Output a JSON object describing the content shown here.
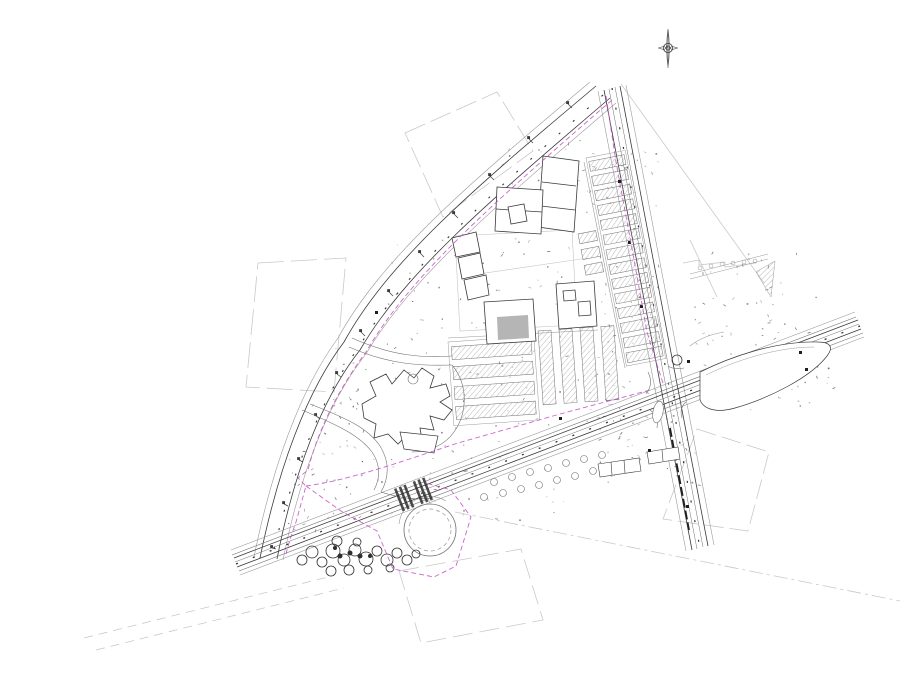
{
  "document": {
    "kind": "cad-site-plan-drawing",
    "background": "#ffffff"
  },
  "palette": {
    "paper": "#ffffff",
    "ink": "#3a3a3a",
    "mid": "#6f6f6f",
    "light": "#9a9a9a",
    "faint": "#c9c9c9",
    "dark": "#1f1f1f",
    "boundary": "#c655c6",
    "building_fill": "#b5b5b5",
    "tree_dark": "#2e2e2e"
  },
  "features": [
    {
      "name": "north-arrow",
      "glyph": "compass-needle"
    },
    {
      "name": "west-curved-road",
      "glyph": "multi-line road band"
    },
    {
      "name": "east-road",
      "glyph": "multi-line road band"
    },
    {
      "name": "south-road",
      "glyph": "multi-line road band"
    },
    {
      "name": "road-intersection",
      "glyph": "crossing with corner fillets"
    },
    {
      "name": "traffic-island",
      "glyph": "teardrop island"
    },
    {
      "name": "main-building-complex",
      "glyph": "courtyard building outlines"
    },
    {
      "name": "west-building",
      "glyph": "irregular star footprint"
    },
    {
      "name": "central-parking-lot",
      "glyph": "hatched stall rows"
    },
    {
      "name": "east-parking-column",
      "glyph": "stacked hatched stall rows"
    },
    {
      "name": "site-boundary",
      "glyph": "magenta dashed line"
    },
    {
      "name": "pond",
      "glyph": "concentric circles"
    },
    {
      "name": "tree-cluster",
      "glyph": "overlapping canopy circles"
    },
    {
      "name": "street-trees",
      "glyph": "small circles"
    },
    {
      "name": "crosswalk",
      "glyph": "striped bars"
    },
    {
      "name": "bus-stop-structures",
      "glyph": "small rectangles"
    },
    {
      "name": "survey-parcels",
      "glyph": "faint dashed quads"
    }
  ]
}
